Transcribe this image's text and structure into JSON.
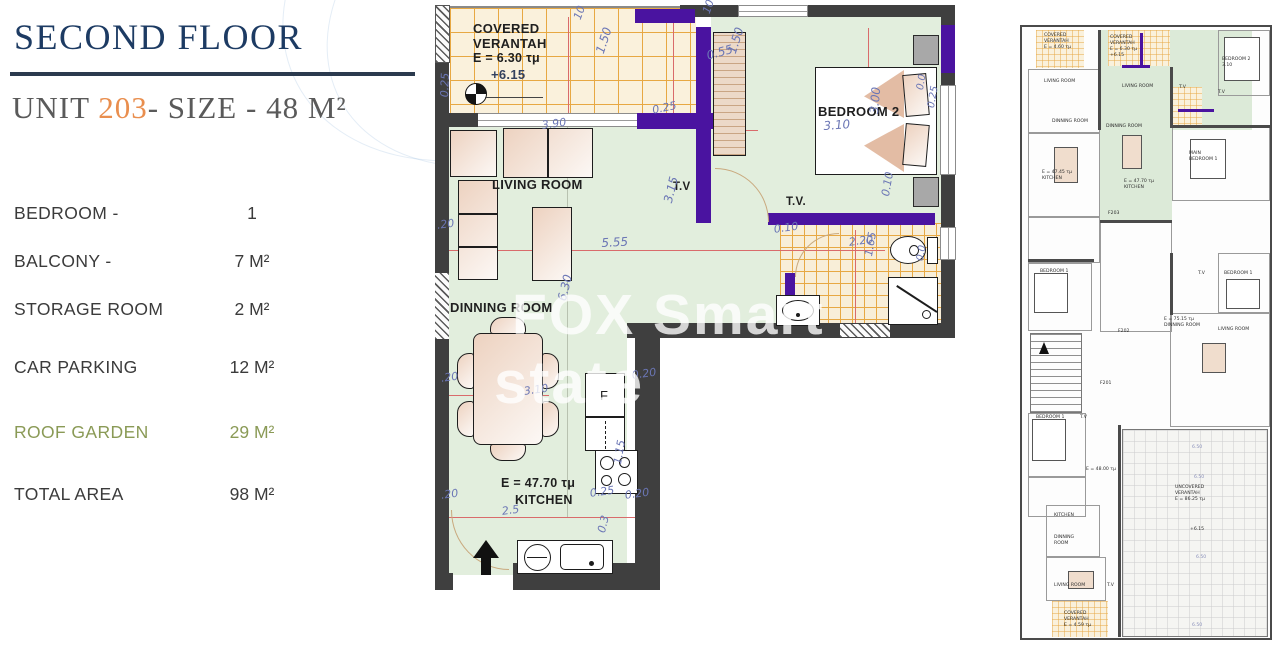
{
  "panel": {
    "title": "SECOND FLOOR",
    "unit_prefix": "UNIT ",
    "unit_number": "203",
    "unit_suffix": "- SIZE - 48 M²",
    "specs": [
      {
        "label": "BEDROOM -",
        "value": "1"
      },
      {
        "label": "BALCONY -",
        "value": "7 M²"
      },
      {
        "label": "STORAGE ROOM",
        "value": "2 M²"
      },
      {
        "label": "CAR PARKING",
        "value": "12 M²"
      },
      {
        "label": "ROOF GARDEN",
        "value": "29 M²"
      },
      {
        "label": "TOTAL AREA",
        "value": "98 M²"
      }
    ],
    "colors": {
      "title_navy": "#1d3b63",
      "accent_orange": "#e98e4e",
      "roof_garden_green": "#8a9a56"
    }
  },
  "watermark": {
    "line1": "FOX Smart",
    "line2": "state"
  },
  "main_plan": {
    "rooms": {
      "covered_line1": "COVERED",
      "covered_line2": "VERANTAH",
      "covered_line3": "E = 6.30 τμ",
      "covered_level": "+6.15",
      "living": "LIVING ROOM",
      "dinning": "DINNING ROOM",
      "kitchen_area": "E = 47.70 τμ",
      "kitchen": "KITCHEN",
      "bedroom2": "BEDROOM 2",
      "tv_left": "T.V",
      "tv_right": "T.V.",
      "fridge": "F"
    },
    "dims": [
      {
        "t": "10",
        "x": 136,
        "y": 12,
        "r": -70
      },
      {
        "t": "10",
        "x": 265,
        "y": 6,
        "r": -70
      },
      {
        "t": "1.50",
        "x": 158,
        "y": 46,
        "r": -72,
        "fs": 12
      },
      {
        "t": "1.50",
        "x": 290,
        "y": 46,
        "r": -72,
        "fs": 12
      },
      {
        "t": "0.55",
        "x": 270,
        "y": 44,
        "r": -15,
        "fs": 12
      },
      {
        "t": "0.25",
        "x": 3,
        "y": 92,
        "r": -88
      },
      {
        "t": "3.90",
        "x": 106,
        "y": 114,
        "r": -8
      },
      {
        "t": "0.25",
        "x": 216,
        "y": 99,
        "r": -12
      },
      {
        "t": "3.10",
        "x": 388,
        "y": 114,
        "r": -4,
        "fs": 12
      },
      {
        "t": "3.00",
        "x": 432,
        "y": 108,
        "r": -85,
        "fs": 12
      },
      {
        "t": "5.55",
        "x": 166,
        "y": 231,
        "r": -3,
        "fs": 12
      },
      {
        "t": "3.15",
        "x": 226,
        "y": 196,
        "r": -76,
        "fs": 12
      },
      {
        "t": "0.10",
        "x": 338,
        "y": 218,
        "r": -8
      },
      {
        "t": "0.10",
        "x": 444,
        "y": 190,
        "r": -80
      },
      {
        "t": "2.20",
        "x": 413,
        "y": 231,
        "r": -8
      },
      {
        "t": "1.65",
        "x": 427,
        "y": 250,
        "r": -80
      },
      {
        "t": "0.0",
        "x": 480,
        "y": 84,
        "r": -80,
        "fs": 10
      },
      {
        "t": "0.25",
        "x": 491,
        "y": 102,
        "r": -80,
        "fs": 10
      },
      {
        "t": "0.0",
        "x": 480,
        "y": 255,
        "r": -80,
        "fs": 10
      },
      {
        "t": "6.30",
        "x": 120,
        "y": 294,
        "r": -76,
        "fs": 12
      },
      {
        "t": ".20",
        "x": 1,
        "y": 214,
        "r": -8
      },
      {
        "t": ".20",
        "x": 5,
        "y": 367,
        "r": -8
      },
      {
        "t": ".20",
        "x": 5,
        "y": 484,
        "r": -8
      },
      {
        "t": "3.10",
        "x": 88,
        "y": 380,
        "r": -8
      },
      {
        "t": "0.20",
        "x": 196,
        "y": 364,
        "r": -8
      },
      {
        "t": "2.5",
        "x": 66,
        "y": 500,
        "r": -8
      },
      {
        "t": "0.25",
        "x": 154,
        "y": 482,
        "r": -8
      },
      {
        "t": "0.20",
        "x": 189,
        "y": 484,
        "r": -8
      },
      {
        "t": "1.15",
        "x": 176,
        "y": 458,
        "r": -80
      },
      {
        "t": "0.3",
        "x": 160,
        "y": 526,
        "r": -76
      }
    ]
  },
  "mini_plan": {
    "labels": [
      {
        "t": "COVERED\nVERANTAH\nE = 4.60 τμ",
        "x": 22,
        "y": 6
      },
      {
        "t": "COVERED\nVERANTAH\nE = 6.30 τμ\n+6.15",
        "x": 88,
        "y": 8
      },
      {
        "t": "BEDROOM 2\n3.10",
        "x": 200,
        "y": 30
      },
      {
        "t": "LIVING ROOM",
        "x": 22,
        "y": 52
      },
      {
        "t": "LIVING ROOM",
        "x": 100,
        "y": 57
      },
      {
        "t": "T.V",
        "x": 157,
        "y": 58
      },
      {
        "t": "T.V",
        "x": 196,
        "y": 63
      },
      {
        "t": "DINNING ROOM",
        "x": 30,
        "y": 92
      },
      {
        "t": "DINNING ROOM",
        "x": 84,
        "y": 97
      },
      {
        "t": "MAIN\nBEDROOM 1",
        "x": 167,
        "y": 124
      },
      {
        "t": "E = 47.45 τμ\nKITCHEN",
        "x": 20,
        "y": 143
      },
      {
        "t": "E = 47.70 τμ\nKITCHEN",
        "x": 102,
        "y": 152
      },
      {
        "t": "F203",
        "x": 86,
        "y": 184
      },
      {
        "t": "F202",
        "x": 96,
        "y": 302
      },
      {
        "t": "F201",
        "x": 78,
        "y": 354
      },
      {
        "t": "BEDROOM 1",
        "x": 18,
        "y": 242
      },
      {
        "t": "T.V",
        "x": 176,
        "y": 244
      },
      {
        "t": "BEDROOM 1",
        "x": 202,
        "y": 244
      },
      {
        "t": "E = 75.15 τμ\nDINNING ROOM",
        "x": 142,
        "y": 290
      },
      {
        "t": "LIVING ROOM",
        "x": 196,
        "y": 300
      },
      {
        "t": "BEDROOM 1",
        "x": 14,
        "y": 388
      },
      {
        "t": "T.V",
        "x": 58,
        "y": 388
      },
      {
        "t": "E = 48.00 τμ",
        "x": 64,
        "y": 440
      },
      {
        "t": "UNCOVERED\nVERANTAH\nE = 86.25 τμ",
        "x": 153,
        "y": 458
      },
      {
        "t": "+6.15",
        "x": 168,
        "y": 500
      },
      {
        "t": "KITCHEN",
        "x": 32,
        "y": 486
      },
      {
        "t": "DINNING\nROOM",
        "x": 32,
        "y": 508
      },
      {
        "t": "LIVING ROOM",
        "x": 32,
        "y": 556
      },
      {
        "t": "T.V",
        "x": 85,
        "y": 556
      },
      {
        "t": "COVERED\nVERANTAH\nE = 4.59 τμ",
        "x": 42,
        "y": 584
      },
      {
        "t": "6.50",
        "x": 170,
        "y": 418,
        "c": "#8a90bb"
      },
      {
        "t": "6.50",
        "x": 172,
        "y": 448,
        "c": "#8a90bb"
      },
      {
        "t": "6.50",
        "x": 174,
        "y": 528,
        "c": "#8a90bb"
      },
      {
        "t": "6.50",
        "x": 170,
        "y": 596,
        "c": "#8a90bb"
      }
    ]
  }
}
